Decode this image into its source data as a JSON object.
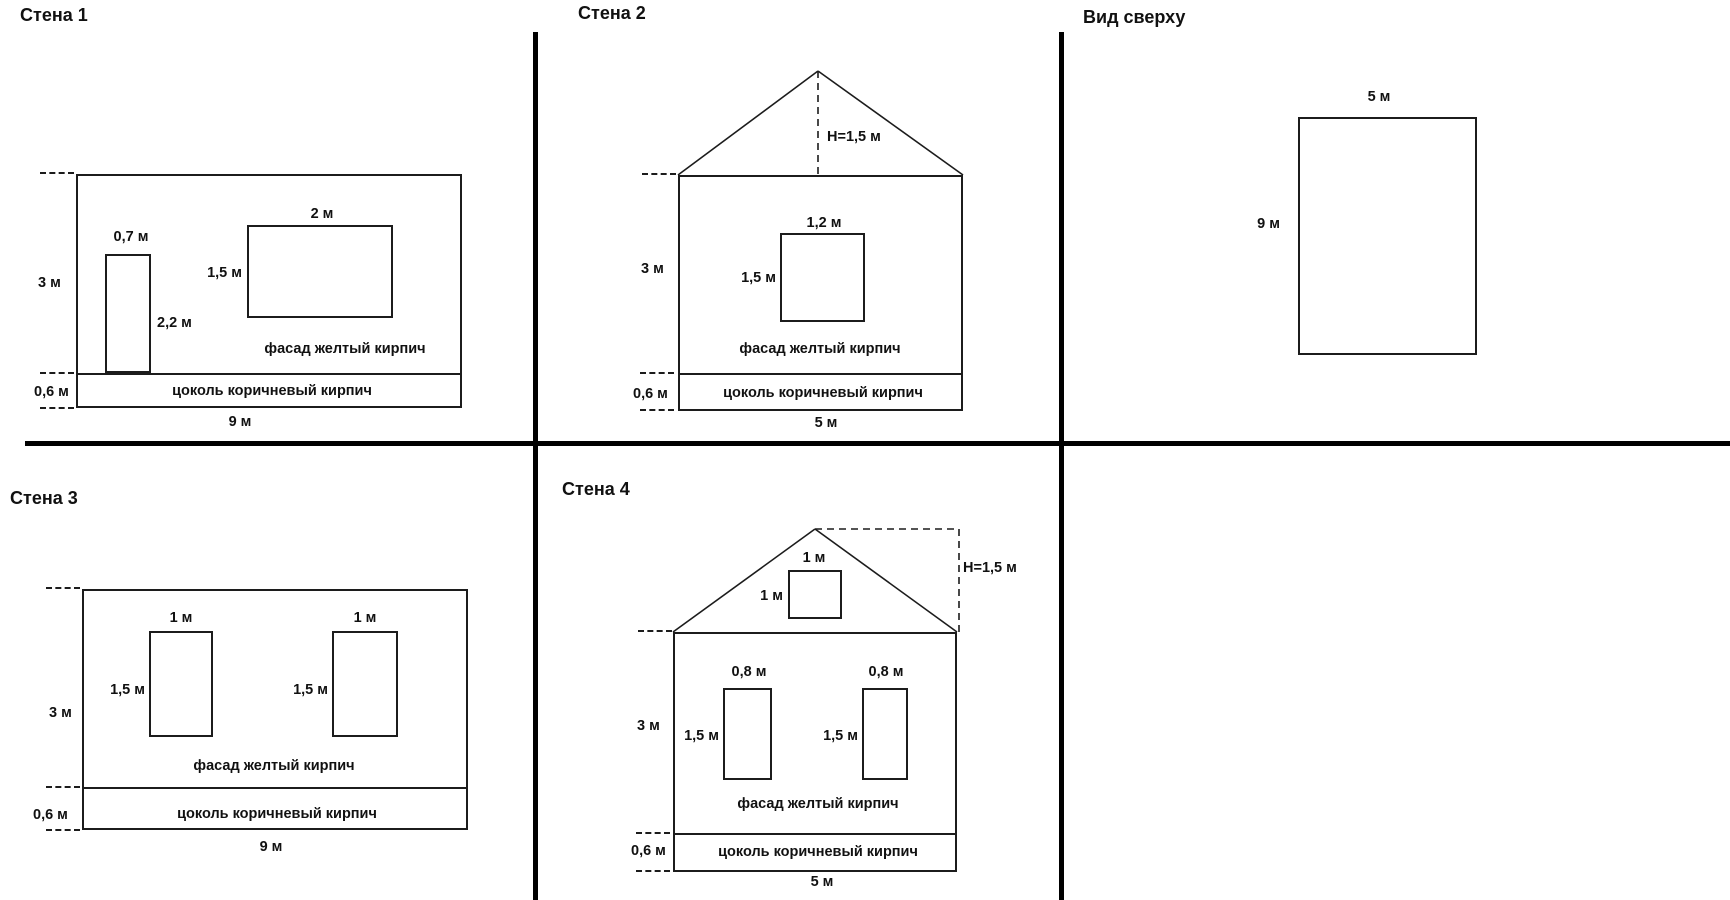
{
  "wall1": {
    "title": "Стена 1",
    "wall_height": "3 м",
    "door_width": "0,7 м",
    "door_height": "2,2 м",
    "window_width": "2 м",
    "window_height": "1,5 м",
    "facade_text": "фасад желтый кирпич",
    "plinth_text": "цоколь коричневый кирпич",
    "plinth_height": "0,6 м",
    "wall_width": "9 м"
  },
  "wall2": {
    "title": "Стена 2",
    "roof_height": "H=1,5 м",
    "wall_height": "3 м",
    "window_width": "1,2 м",
    "window_height": "1,5 м",
    "facade_text": "фасад желтый кирпич",
    "plinth_text": "цоколь коричневый кирпич",
    "plinth_height": "0,6 м",
    "wall_width": "5 м"
  },
  "top_view": {
    "title": "Вид сверху",
    "width": "5 м",
    "depth": "9 м"
  },
  "wall3": {
    "title": "Стена 3",
    "wall_height": "3 м",
    "window1_width": "1 м",
    "window1_height": "1,5 м",
    "window2_width": "1 м",
    "window2_height": "1,5 м",
    "facade_text": "фасад желтый кирпич",
    "plinth_text": "цоколь коричневый кирпич",
    "plinth_height": "0,6 м",
    "wall_width": "9 м"
  },
  "wall4": {
    "title": "Стена 4",
    "roof_height": "H=1,5 м",
    "attic_window_width": "1 м",
    "attic_window_height": "1 м",
    "wall_height": "3 м",
    "window1_width": "0,8 м",
    "window1_height": "1,5 м",
    "window2_width": "0,8 м",
    "window2_height": "1,5 м",
    "facade_text": "фасад желтый кирпич",
    "plinth_text": "цоколь коричневый кирпич",
    "plinth_height": "0,6 м",
    "wall_width": "5 м"
  },
  "colors": {
    "ink": "#1c1c1c",
    "divider": "#000000",
    "background": "#ffffff"
  }
}
